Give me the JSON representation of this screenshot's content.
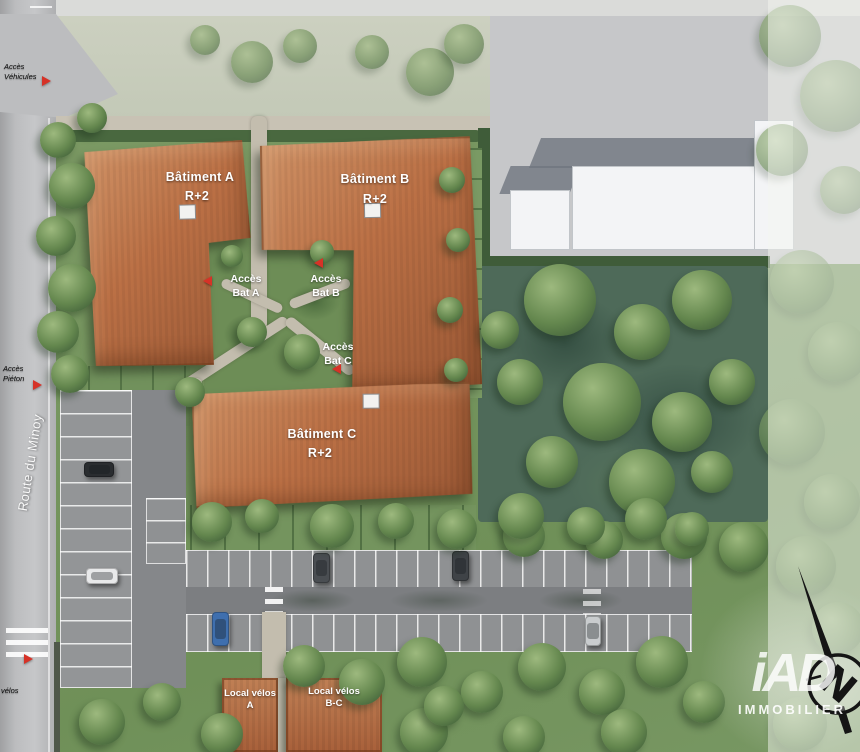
{
  "site": {
    "buildings": [
      {
        "id": "A",
        "name": "Bâtiment A",
        "floors": "R+2"
      },
      {
        "id": "B",
        "name": "Bâtiment B",
        "floors": "R+2"
      },
      {
        "id": "C",
        "name": "Bâtiment C",
        "floors": "R+2"
      }
    ],
    "access_labels": [
      {
        "line1": "Accès",
        "line2": "Bat A"
      },
      {
        "line1": "Accès",
        "line2": "Bat B"
      },
      {
        "line1": "Accès",
        "line2": "Bat C"
      }
    ],
    "bike_sheds": [
      {
        "line1": "Local vélos",
        "line2": "A"
      },
      {
        "line1": "Local vélos",
        "line2": "B-C"
      }
    ],
    "road_name": "Route du Minoy",
    "entry_labels": [
      {
        "line1": "Accès",
        "line2": "Véhicules"
      },
      {
        "line1": "Accès",
        "line2": "Piéton"
      },
      {
        "line1": "",
        "line2": "vélos"
      }
    ]
  },
  "branding": {
    "logo_main": "iAD",
    "logo_sub": "IMMOBILIER"
  },
  "compass": {
    "north_label": "N"
  },
  "theme": {
    "roof": "#bb7045",
    "roof_dark": "#9a5835",
    "water": "#4e6a59",
    "grass": "#7b9a64",
    "accent_red": "#d63227",
    "asphalt": "#8f9193",
    "road": "#bcbdbf",
    "path": "#c3bdae",
    "white_bld": "#f3f4f6"
  }
}
